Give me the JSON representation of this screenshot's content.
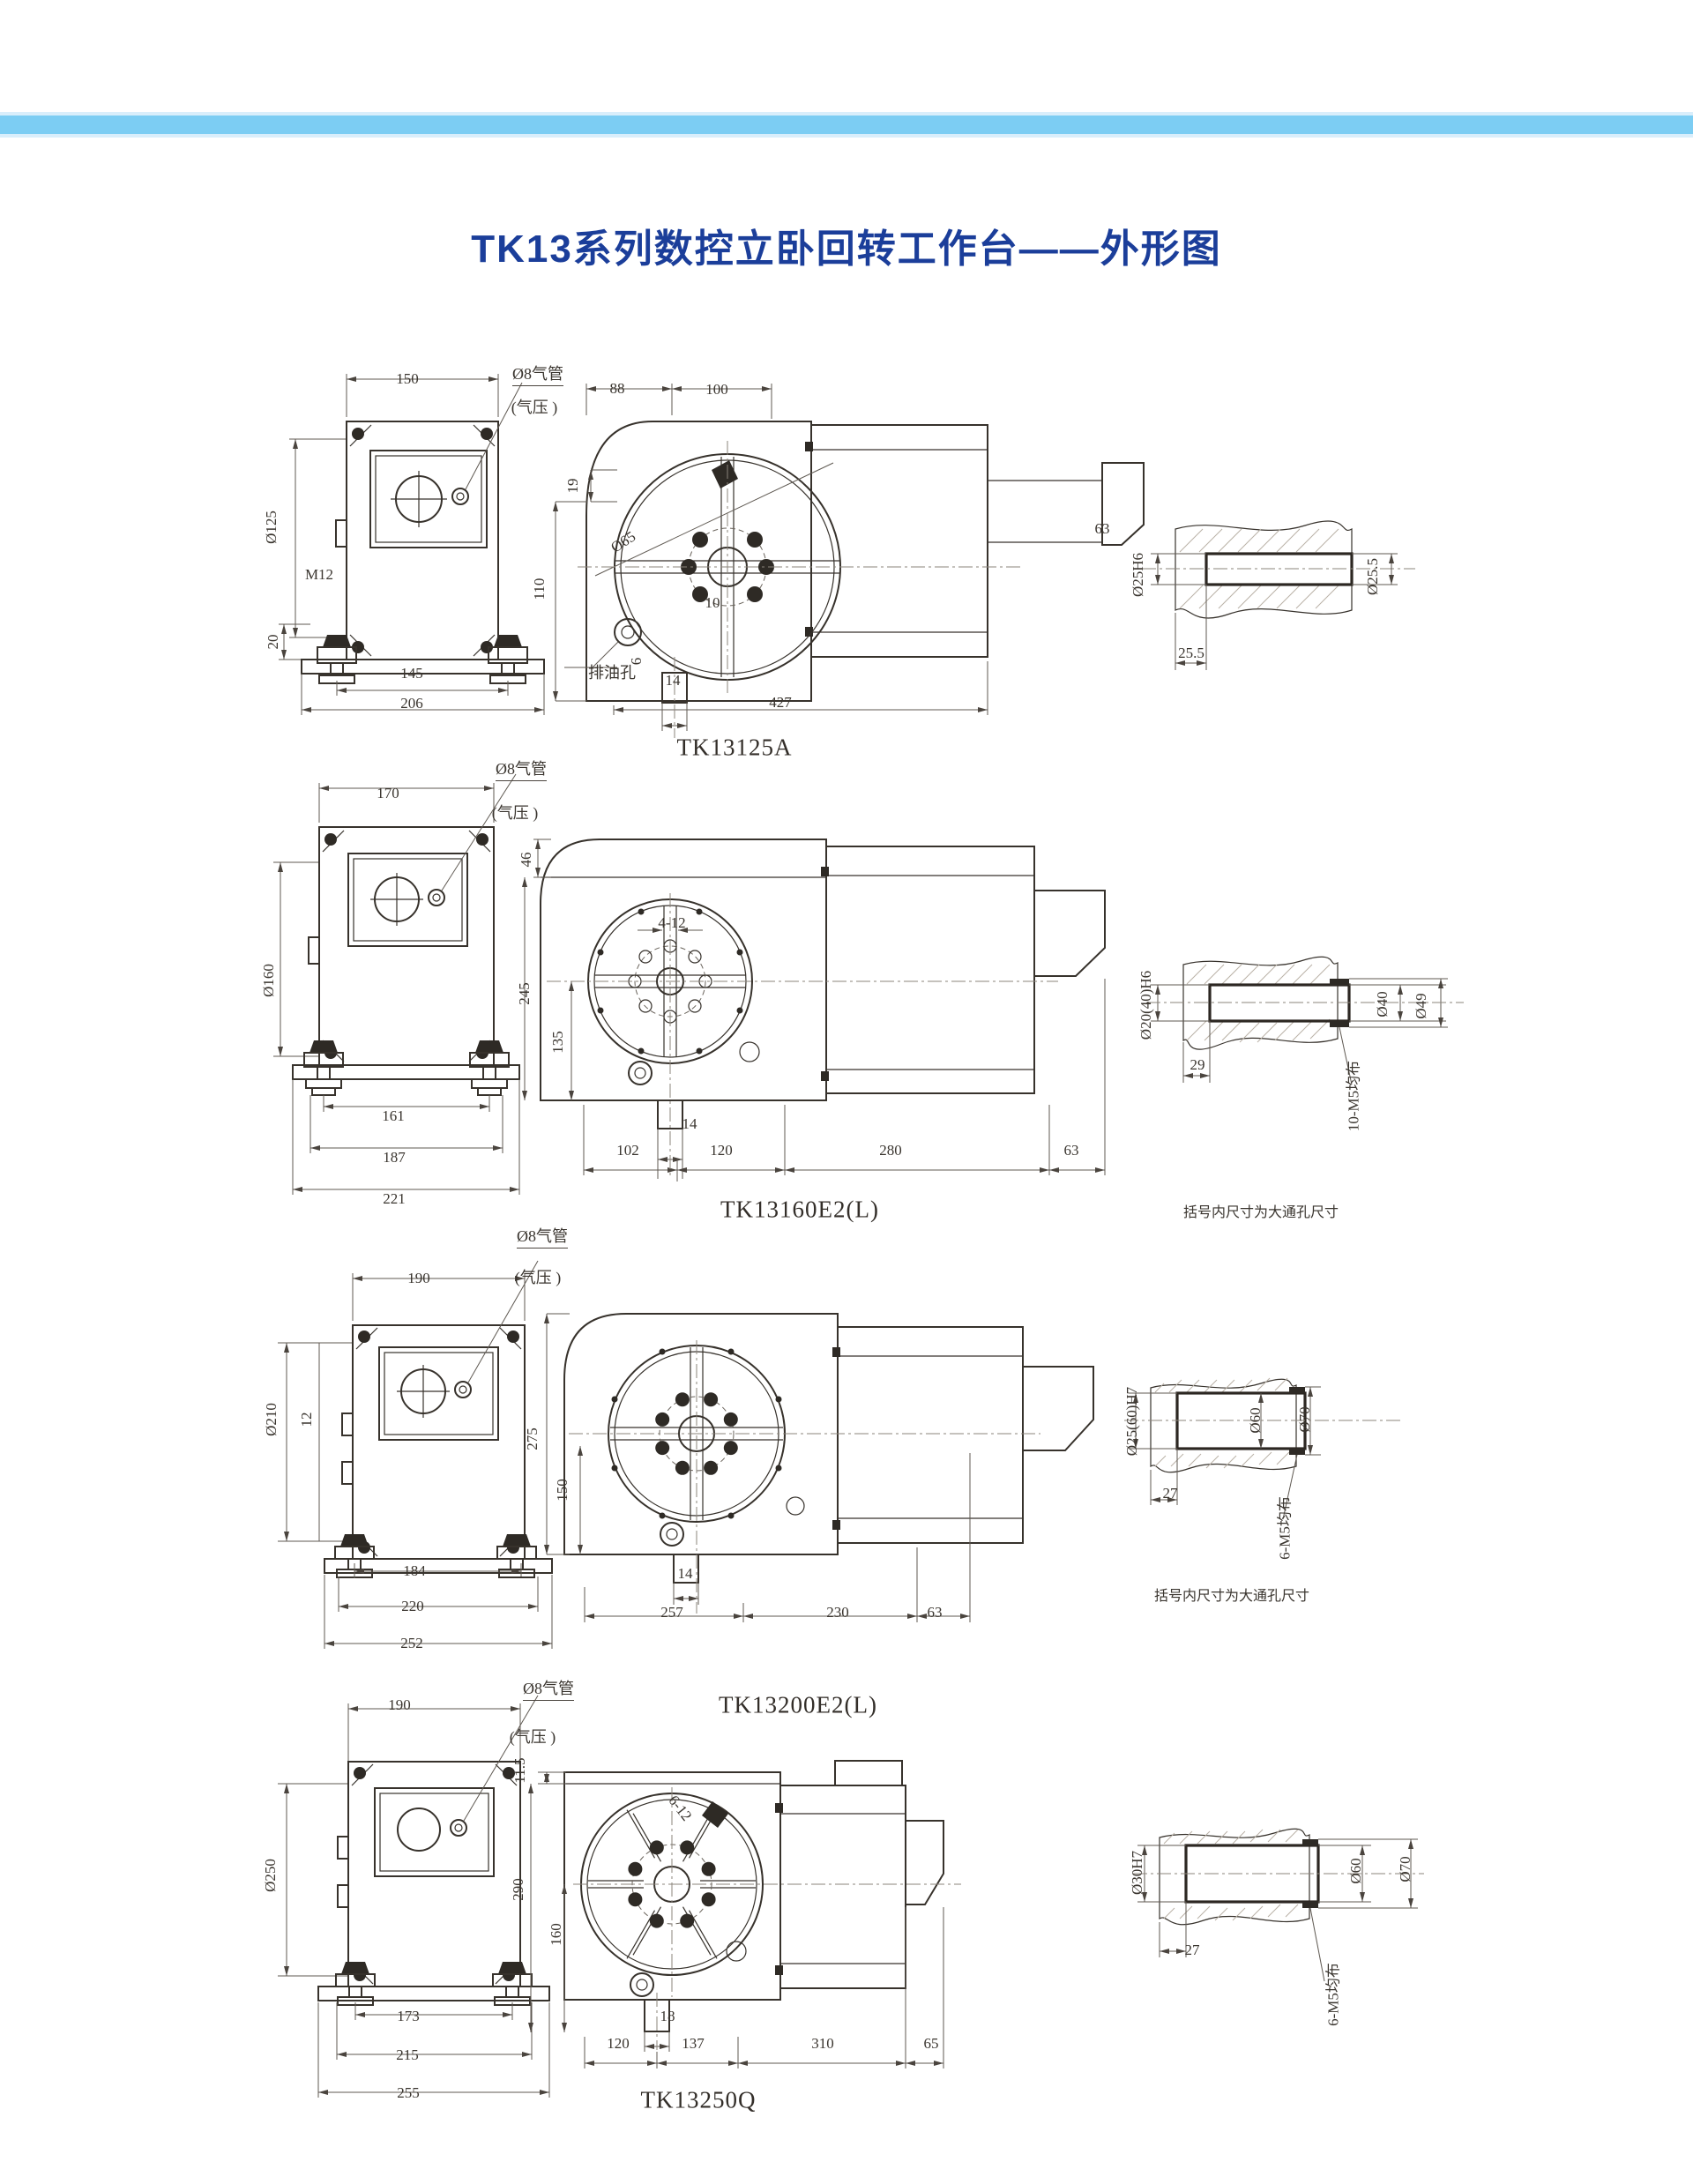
{
  "page": {
    "title": "TK13系列数控立卧回转工作台——外形图",
    "title_color": "#1b3e9a",
    "topbar_color": "#7ccdf3",
    "topbar_edge_color": "#d9eefb"
  },
  "shared": {
    "air_pipe": "Ø8气管",
    "air_pressure": "(气压 )",
    "drain_hole": "排油孔",
    "bracket_note": "括号内尺寸为大通孔尺寸"
  },
  "rows": [
    {
      "model": "TK13125A",
      "front": {
        "top": "150",
        "dia": "Ø125",
        "thread": "M12",
        "foot": "20",
        "b1": "145",
        "b2": "206"
      },
      "side": {
        "t1": "88",
        "t2": "100",
        "l1": "19",
        "l2": "110",
        "d1": "10",
        "d2": "Ø65",
        "d3": "6",
        "d4": "14",
        "b1": "427",
        "step": "63"
      },
      "shaft": {
        "left": "Ø25H6",
        "right": "Ø25.5",
        "bottom": "25.5"
      }
    },
    {
      "model": "TK13160E2(L)",
      "front": {
        "top": "170",
        "dia": "Ø160",
        "b1": "161",
        "b2": "187",
        "b3": "221"
      },
      "side": {
        "l1": "46",
        "l2": "245",
        "l3": "135",
        "slots": "4-12",
        "d4": "14",
        "b1": "102",
        "b2": "120",
        "b3": "280",
        "step": "63"
      },
      "shaft": {
        "left": "Ø20(40)H6",
        "mid": "Ø40",
        "right": "Ø49",
        "bottom": "29",
        "bolts": "10-M5均布"
      }
    },
    {
      "model": "TK13200E2(L)",
      "front": {
        "top": "190",
        "dia": "Ø210",
        "tab": "12",
        "b1": "184",
        "b2": "220",
        "b3": "252"
      },
      "side": {
        "l1": "275",
        "l2": "150",
        "d4": "14",
        "b1": "257",
        "b2": "230",
        "b3": "63"
      },
      "shaft": {
        "left": "Ø25(60)H7",
        "mid": "Ø60",
        "right": "Ø70",
        "bottom": "27",
        "bolts": "6-M5均布"
      }
    },
    {
      "model": "TK13250Q",
      "front": {
        "top": "190",
        "dia": "Ø250",
        "b1": "173",
        "b2": "215",
        "b3": "255"
      },
      "side": {
        "l1": "11.5",
        "l2": "290",
        "l3": "160",
        "slots": "6-12",
        "d1": "18",
        "b1": "120",
        "b2": "137",
        "b3": "310",
        "b4": "65"
      },
      "shaft": {
        "left": "Ø30H7",
        "mid": "Ø60",
        "right": "Ø70",
        "bottom": "27",
        "bolts": "6-M5均布"
      }
    }
  ]
}
